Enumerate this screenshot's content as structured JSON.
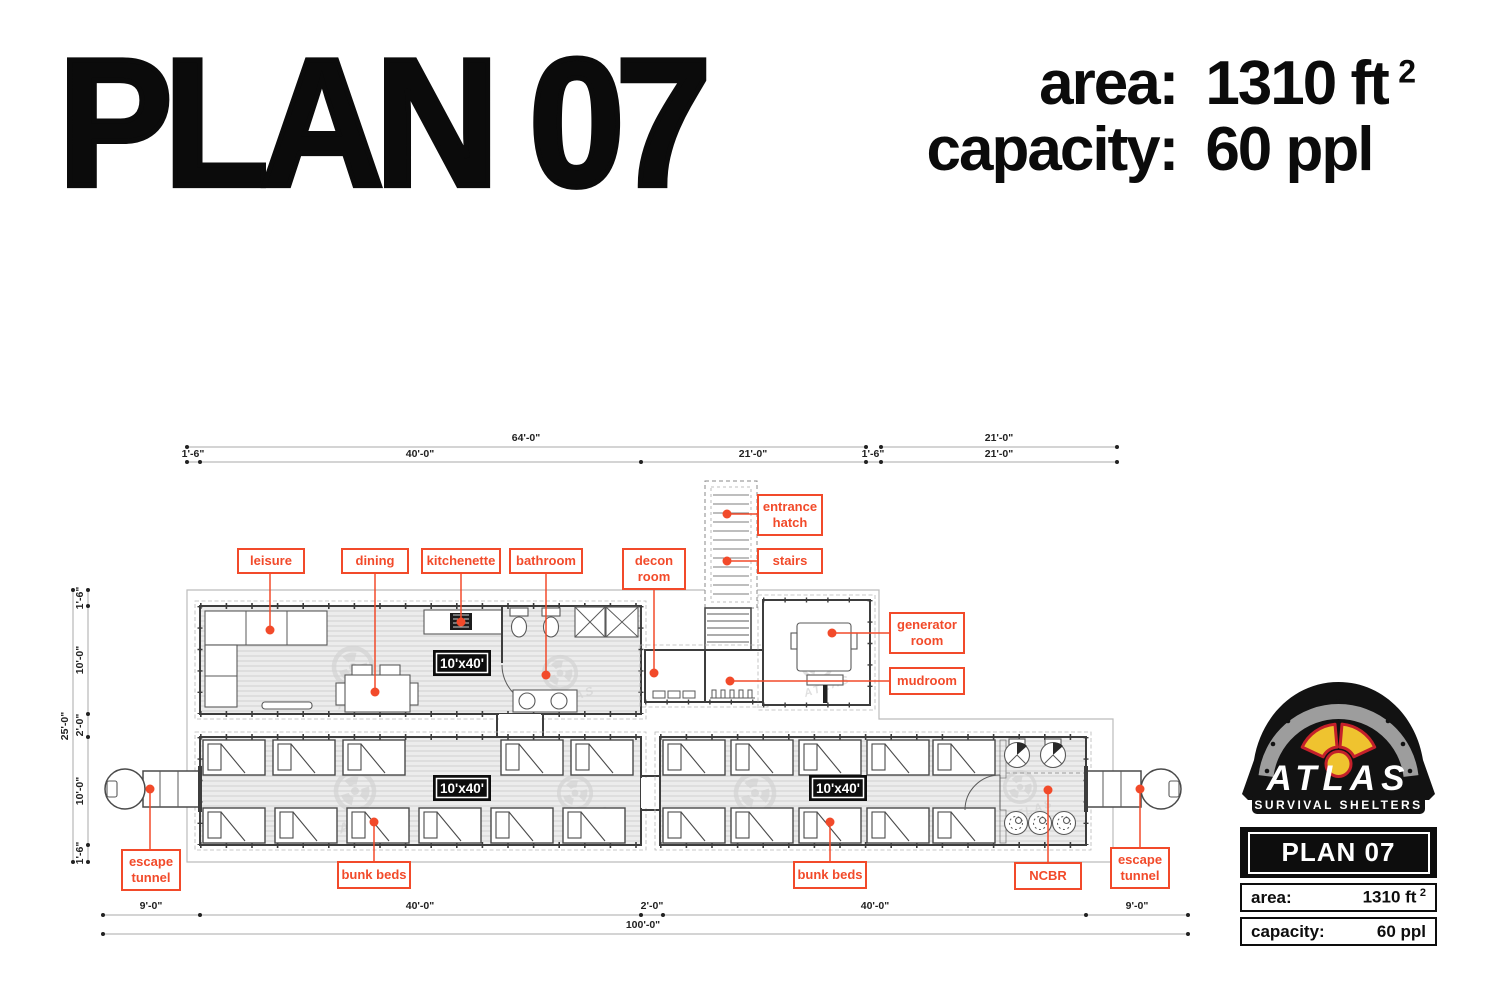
{
  "header": {
    "title": "PLAN 07",
    "area_label": "area:",
    "area_value": "1310 ft",
    "area_sup": "2",
    "capacity_label": "capacity:",
    "capacity_value": "60 ppl"
  },
  "labels": {
    "leisure": "leisure",
    "dining": "dining",
    "kitchenette": "kitchenette",
    "bathroom": "bathroom",
    "decon_room": [
      "decon",
      "room"
    ],
    "entrance_hatch": [
      "entrance",
      "hatch"
    ],
    "stairs": "stairs",
    "generator_room": [
      "generator",
      "room"
    ],
    "mudroom": "mudroom",
    "escape_tunnel": [
      "escape",
      "tunnel"
    ],
    "bunk_beds": "bunk beds",
    "ncbr": "NCBR",
    "container_size": "10'x40'"
  },
  "dims": {
    "d64": "64'-0\"",
    "d21": "21'-0\"",
    "d16": "1'-6\"",
    "d40": "40'-0\"",
    "d25": "25'-0\"",
    "d10": "10'-0\"",
    "d2": "2'-0\"",
    "d9": "9'-0\"",
    "d100": "100'-0\""
  },
  "watermark": "ATLAS",
  "logo": {
    "brand": "ATLAS",
    "tagline": "SURVIVAL SHELTERS",
    "plan_name": "PLAN 07",
    "area_label": "area:",
    "area_value": "1310 ft",
    "area_sup": "2",
    "capacity_label": "capacity:",
    "capacity_value": "60 ppl"
  },
  "colors": {
    "accent": "#f24a2a",
    "yellow": "#efc32f",
    "red": "#c4202a"
  }
}
